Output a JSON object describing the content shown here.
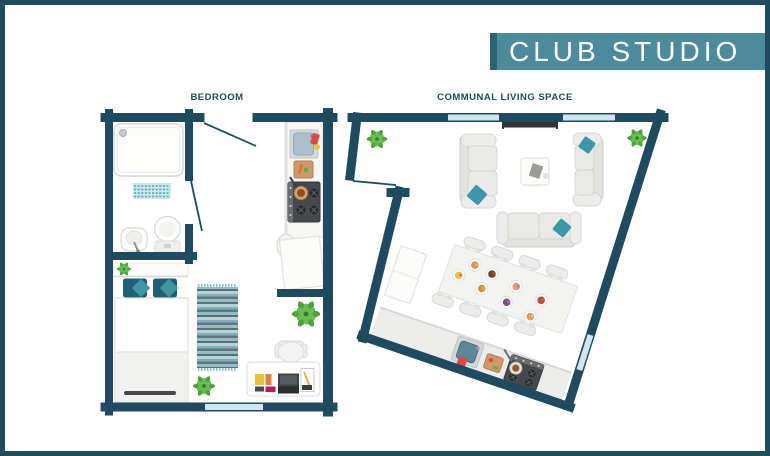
{
  "banner": {
    "title": "CLUB STUDIO"
  },
  "plans": {
    "bedroom": {
      "label": "BEDROOM",
      "furniture": [
        "shower",
        "bath-mat",
        "hand-basin",
        "toilet",
        "entry-door",
        "bathroom-door",
        "kitchenette-sink",
        "cutting-board",
        "stove",
        "counter-table",
        "counter-chair",
        "headboard-shelf",
        "pillows",
        "bed",
        "rug",
        "desk",
        "desk-chair",
        "books",
        "laptop",
        "notepad",
        "plant-small",
        "plant-floor",
        "plant-large",
        "window"
      ]
    },
    "communal": {
      "label": "COMMUNAL LIVING SPACE",
      "furniture": [
        "entry-door",
        "tv",
        "sofa-left",
        "sofa-right",
        "sofa-front",
        "coffee-table",
        "cabinet",
        "dining-table",
        "dining-chairs",
        "food-plates",
        "kitchen-counter",
        "kitchen-sink",
        "towel",
        "cutting-board",
        "stove",
        "plant-top-left",
        "plant-top-right",
        "windows"
      ]
    }
  },
  "colors": {
    "wall": "#1e4b5e",
    "banner_bg": "#4d8a9c",
    "banner_accent": "#2b6474",
    "banner_text": "#ffffff",
    "window": "#cfe5ef",
    "label_text": "#1e4b5e",
    "cushion_teal": "#3d98a5",
    "pillow_teal": "#1f6173",
    "plant_green": "#4ea23c",
    "rug_teal": "#8fbec6"
  }
}
